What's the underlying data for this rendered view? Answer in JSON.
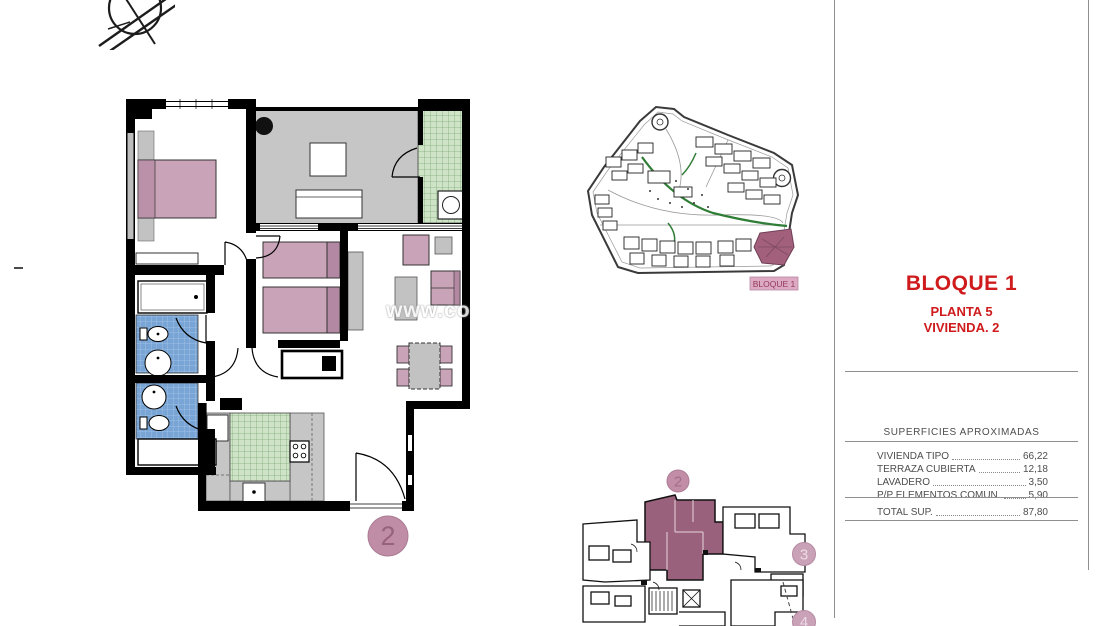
{
  "title_block": {
    "building": "BLOQUE 1",
    "floor": "PLANTA 5",
    "unit": "VIVIENDA. 2",
    "text_color": "#cf1b1c"
  },
  "areas_table": {
    "title": "SUPERFICIES APROXIMADAS",
    "rows": [
      {
        "label": "VIVIENDA TIPO",
        "value": "66,22"
      },
      {
        "label": "TERRAZA CUBIERTA",
        "value": "12,18"
      },
      {
        "label": "LAVADERO",
        "value": "3,50"
      },
      {
        "label": "P/P ELEMENTOS COMUN.",
        "value": "5,90"
      }
    ],
    "total": {
      "label": "TOTAL SUP.",
      "value": "87,80"
    }
  },
  "site_plan": {
    "block_label": "BLOQUE 1",
    "highlight_color": "#a2607c",
    "label_bg": "#dcaac2"
  },
  "floor_plan": {
    "unit_circle": "2"
  },
  "key_plan": {
    "circles": [
      "2",
      "3",
      "4"
    ],
    "highlight_color": "#99617b"
  },
  "watermark": {
    "text": "www.co"
  },
  "colors": {
    "furniture_pink": "#c9a3b8",
    "tile_blue": "#79a5d6",
    "tile_green": "#cfe4c6",
    "terrace_gray": "#c6c6c6",
    "circle_pink": "#c08da6"
  }
}
